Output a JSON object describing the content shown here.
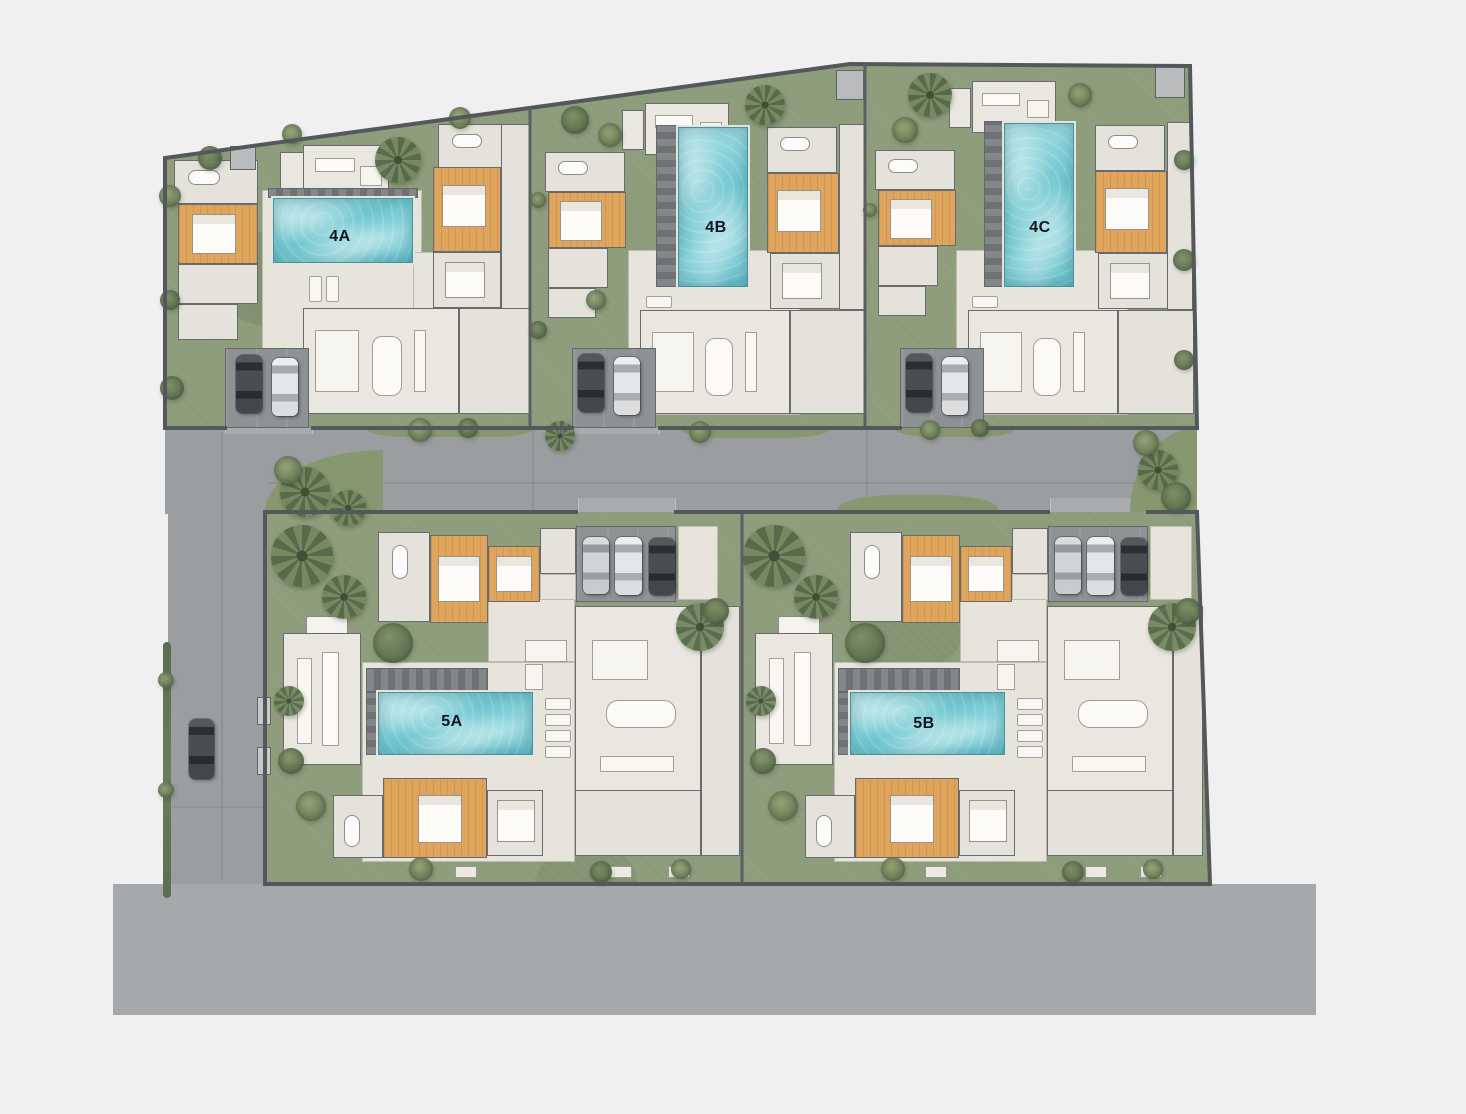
{
  "plan": {
    "type": "villa-development-site-plan",
    "rows": [
      {
        "name": "upper-row",
        "villas": [
          "4A",
          "4B",
          "4C"
        ]
      },
      {
        "name": "lower-row",
        "villas": [
          "5A",
          "5B"
        ]
      }
    ]
  },
  "villas": [
    {
      "id": "4A",
      "label": "4A"
    },
    {
      "id": "4B",
      "label": "4B"
    },
    {
      "id": "4C",
      "label": "4C"
    },
    {
      "id": "5A",
      "label": "5A"
    },
    {
      "id": "5B",
      "label": "5B"
    }
  ],
  "colors": {
    "background": "#eff0ef",
    "road": "#9b9ea1",
    "road_lower_band": "#a6a9ac",
    "garden_green": "#8d9c7b",
    "boundary_wall": "#54585b",
    "floor_beige": "#e9e7e0",
    "bedroom_wood": "#e0a55d",
    "pool_water": "#6ec6cf",
    "pool_deck": "#7a7d80",
    "tree_green": "#5f7250",
    "label_text": "#0e1722"
  }
}
